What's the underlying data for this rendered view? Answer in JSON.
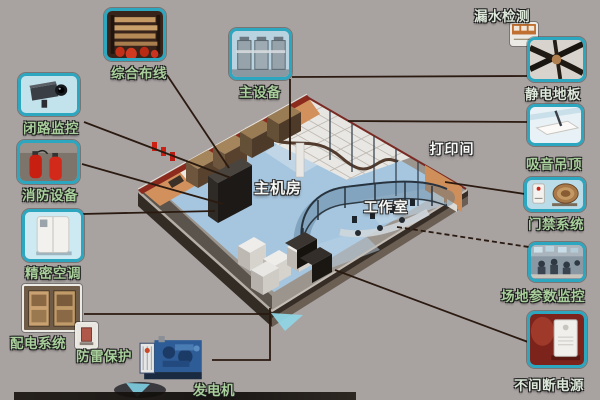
{
  "background_color": "#a8a2a1",
  "connector_color": "#2a1a10",
  "tile_border_color": "#2da7c0",
  "rooms": [
    {
      "name": "main-machine-room",
      "label": "主机房"
    },
    {
      "name": "work-room",
      "label": "工作室"
    },
    {
      "name": "print-room",
      "label": "打印间"
    }
  ],
  "components": [
    {
      "name": "integrated-cabling",
      "label": "综合布线"
    },
    {
      "name": "cctv-monitoring",
      "label": "闭路监控"
    },
    {
      "name": "fire-equipment",
      "label": "消防设备"
    },
    {
      "name": "precision-air-conditioning",
      "label": "精密空调"
    },
    {
      "name": "power-distribution",
      "label": "配电系统"
    },
    {
      "name": "lightning-protection",
      "label": "防雷保护"
    },
    {
      "name": "generator",
      "label": "发电机"
    },
    {
      "name": "main-equipment",
      "label": "主设备"
    },
    {
      "name": "leak-detection",
      "label": "漏水检测"
    },
    {
      "name": "antistatic-floor",
      "label": "静电地板"
    },
    {
      "name": "acoustic-ceiling",
      "label": "吸音吊顶"
    },
    {
      "name": "access-control",
      "label": "门禁系统"
    },
    {
      "name": "site-parameter-monitoring",
      "label": "场地参数监控"
    },
    {
      "name": "ups",
      "label": "不间断电源"
    }
  ]
}
